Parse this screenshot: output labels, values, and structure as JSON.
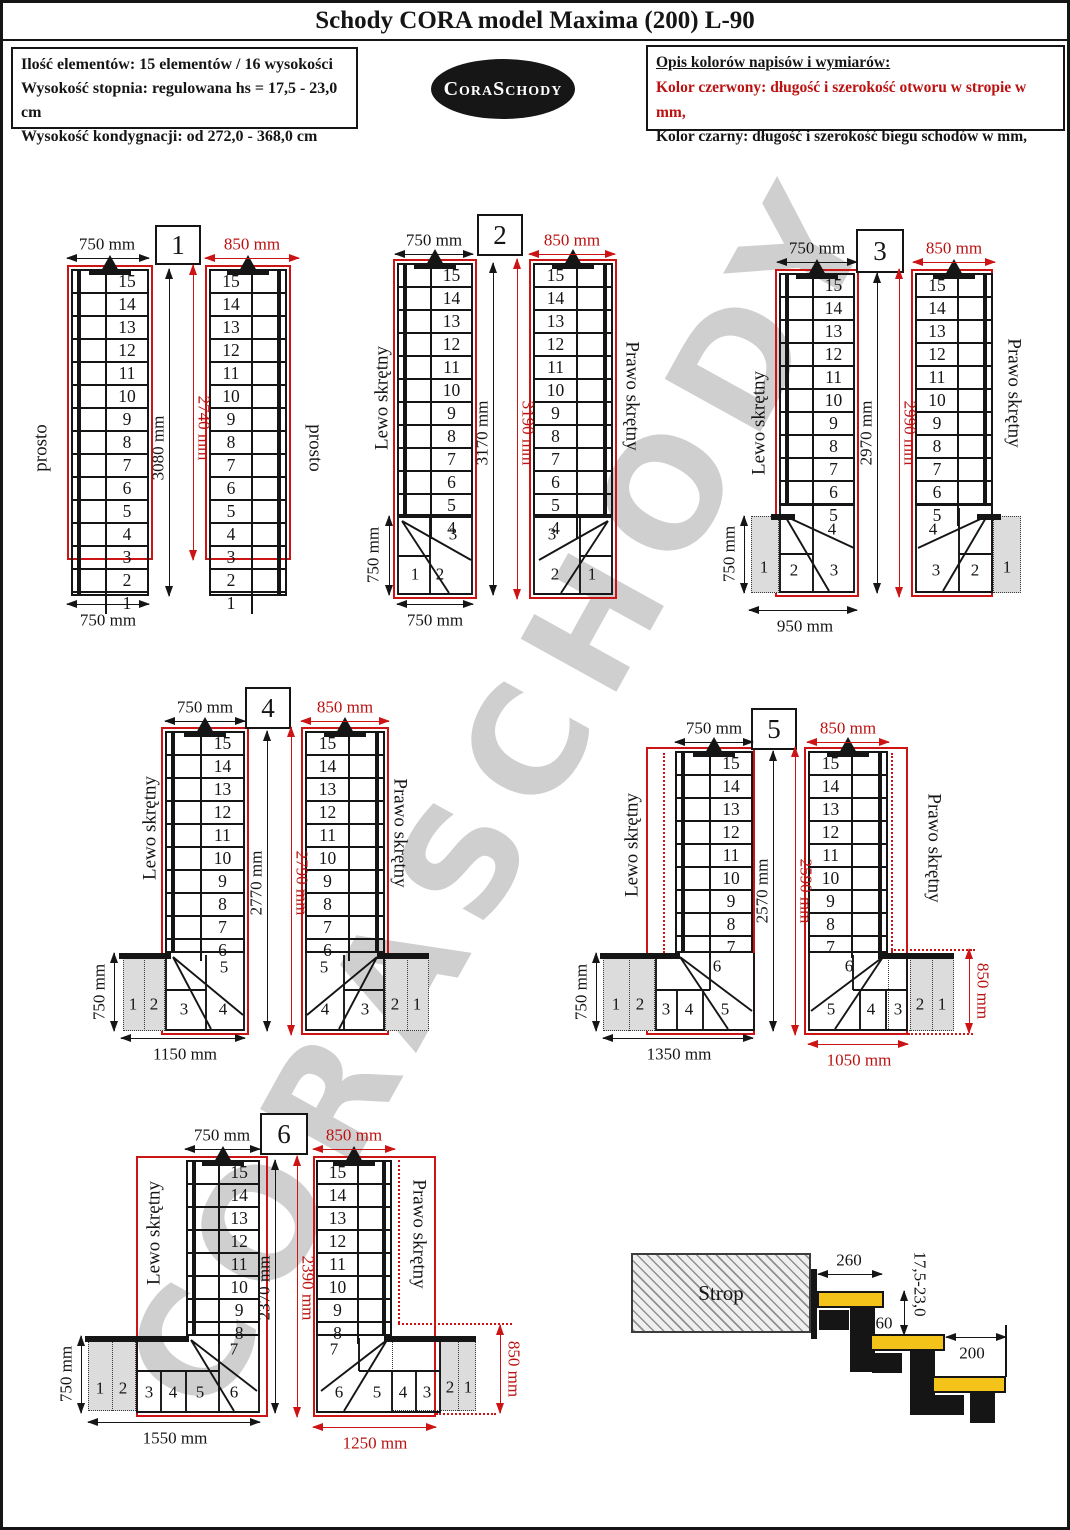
{
  "title": "Schody CORA model Maxima (200) L-90",
  "info": [
    "Ilość elementów: 15 elementów / 16 wysokości",
    "Wysokość stopnia: regulowana  hs = 17,5 - 23,0 cm",
    "Wysokość kondygnacji: od 272,0 - 368,0 cm"
  ],
  "logo": "CoraSchody",
  "legend": {
    "heading": "Opis kolorów napisów i wymiarów:",
    "red": "Kolor czerwony:  długość i szerokość otworu w stropie w mm,",
    "black": "Kolor czarny:  długość i szerokość biegu schodów w mm,"
  },
  "watermark": "CORASCHODY",
  "colors": {
    "red": "#cc1414",
    "ink": "#151515",
    "gray_fill": "#dcdcdc",
    "watermark": "#cfcfcf",
    "tread_yellow": "#f3c31a"
  },
  "steps": {
    "full": [
      15,
      14,
      13,
      12,
      11,
      10,
      9,
      8,
      7,
      6,
      5,
      4,
      3,
      2,
      1
    ],
    "to4": [
      15,
      14,
      13,
      12,
      11,
      10,
      9,
      8,
      7,
      6,
      5,
      4
    ],
    "to5": [
      15,
      14,
      13,
      12,
      11,
      10,
      9,
      8,
      7,
      6,
      5
    ],
    "to6": [
      15,
      14,
      13,
      12,
      11,
      10,
      9,
      8,
      7,
      6
    ],
    "to7": [
      15,
      14,
      13,
      12,
      11,
      10,
      9,
      8,
      7
    ],
    "to8": [
      15,
      14,
      13,
      12,
      11,
      10,
      9,
      8
    ]
  },
  "diagrams": [
    {
      "number": "1",
      "left_label": "prosto",
      "right_label": "prosto",
      "top_black": "750 mm",
      "top_red": "850 mm",
      "len_black": "3080 mm",
      "len_red": "2740 mm",
      "bottom_black": "750 mm"
    },
    {
      "number": "2",
      "left_label": "Lewo skrętny",
      "right_label": "Prawo skrętny",
      "top_black": "750 mm",
      "top_red": "850 mm",
      "len_black": "3170 mm",
      "len_red": "3190 mm",
      "side_black": "750 mm",
      "bottom_black": "750 mm",
      "winder": "3",
      "left_cells": [
        "1",
        "2"
      ],
      "right_cells": [
        "2",
        "1"
      ]
    },
    {
      "number": "3",
      "left_label": "Lewo skrętny",
      "right_label": "Prawo skrętny",
      "top_black": "750 mm",
      "top_red": "850 mm",
      "len_black": "2970 mm",
      "len_red": "2990 mm",
      "side_black": "750 mm",
      "bottom_black": "950 mm",
      "winder": "4",
      "left_cells": [
        "1",
        "2",
        "3"
      ],
      "right_cells": [
        "3",
        "2",
        "1"
      ]
    },
    {
      "number": "4",
      "left_label": "Lewo skrętny",
      "right_label": "Prawo skrętny",
      "top_black": "750 mm",
      "top_red": "850 mm",
      "len_black": "2770 mm",
      "len_red": "2790 mm",
      "side_black": "750 mm",
      "bottom_black": "1150 mm",
      "winder": "5",
      "left_cells": [
        "1",
        "2",
        "3",
        "4"
      ],
      "right_cells": [
        "4",
        "3",
        "2",
        "1"
      ]
    },
    {
      "number": "5",
      "left_label": "Lewo skrętny",
      "right_label": "Prawo skrętny",
      "top_black": "750 mm",
      "top_red": "850 mm",
      "len_black": "2570 mm",
      "len_red": "2590 mm",
      "side_black": "750 mm",
      "bottom_black": "1350 mm",
      "bottom_red": "1050 mm",
      "side_red": "850 mm",
      "winder": "6",
      "left_cells": [
        "1",
        "2",
        "3",
        "4",
        "5"
      ],
      "right_cells": [
        "5",
        "4",
        "3",
        "2",
        "1"
      ]
    },
    {
      "number": "6",
      "left_label": "Lewo skrętny",
      "right_label": "Prawo skrętny",
      "top_black": "750 mm",
      "top_red": "850 mm",
      "len_black": "2370 mm",
      "len_red": "2390 mm",
      "side_black": "750 mm",
      "bottom_black": "1550 mm",
      "bottom_red": "1250 mm",
      "side_red": "850 mm",
      "winder": "7",
      "left_cells": [
        "1",
        "2",
        "3",
        "4",
        "5",
        "6"
      ],
      "right_cells": [
        "6",
        "5",
        "4",
        "3",
        "2",
        "1"
      ]
    }
  ],
  "detail": {
    "strop": "Strop",
    "depth": "260",
    "rise": "17,5-23,0",
    "overlap": "60",
    "module": "200"
  }
}
